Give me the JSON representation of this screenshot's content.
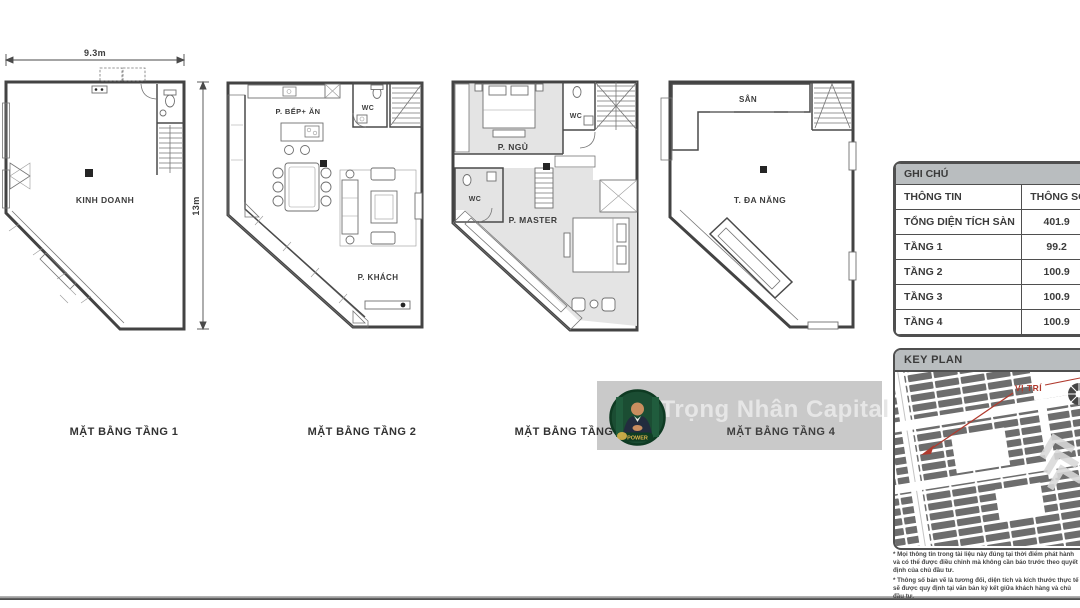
{
  "plans": [
    {
      "caption": "MẶT BẰNG TẦNG 1",
      "dim_width": "9.3m",
      "dim_height": "13m",
      "rooms": {
        "main": "KINH DOANH"
      }
    },
    {
      "caption": "MẶT BẰNG TẦNG 2",
      "rooms": {
        "kitchen": "P. BẾP+ ĂN",
        "wc": "WC",
        "living": "P. KHÁCH"
      }
    },
    {
      "caption": "MẶT BẰNG TẦNG 3",
      "rooms": {
        "bedroom": "P. NGỦ",
        "wc_top": "WC",
        "wc_left": "WC",
        "master": "P. MASTER"
      }
    },
    {
      "caption": "MẶT BẰNG TẦNG 4",
      "rooms": {
        "terrace": "SÂN",
        "multi": "T. ĐA NĂNG"
      }
    }
  ],
  "legend_table": {
    "title": "GHI CHÚ",
    "col1_header": "THÔNG TIN",
    "col2_header": "THÔNG SỐ (m²)",
    "rows": [
      {
        "label": "TỔNG DIỆN TÍCH SÀN",
        "value": "401.9"
      },
      {
        "label": "TẦNG 1",
        "value": "99.2"
      },
      {
        "label": "TẦNG 2",
        "value": "100.9"
      },
      {
        "label": "TẦNG 3",
        "value": "100.9"
      },
      {
        "label": "TẦNG 4",
        "value": "100.9"
      }
    ]
  },
  "key_plan": {
    "title": "KEY PLAN",
    "location_label": "VỊ TRÍ"
  },
  "watermark": {
    "brand": "Trọng Nhân Capital",
    "logo_text": "POWER"
  },
  "disclaimer": {
    "line1": "* Mọi thông tin trong tài liệu này đúng tại thời điểm phát hành và có thể được điều chỉnh mà không cần báo trước theo quyết định của chủ đầu tư.",
    "line2": "* Thông số bản vẽ là tương đối, diện tích và kích thước thực tế sẽ được quy định tại văn bản ký kết giữa khách hàng và chủ đầu tư."
  },
  "colors": {
    "accent_red": "#b03a2e",
    "header_gray": "#b9bdbf",
    "plan_line": "#4a4a4a",
    "room_fill": "#e4e4e4"
  }
}
